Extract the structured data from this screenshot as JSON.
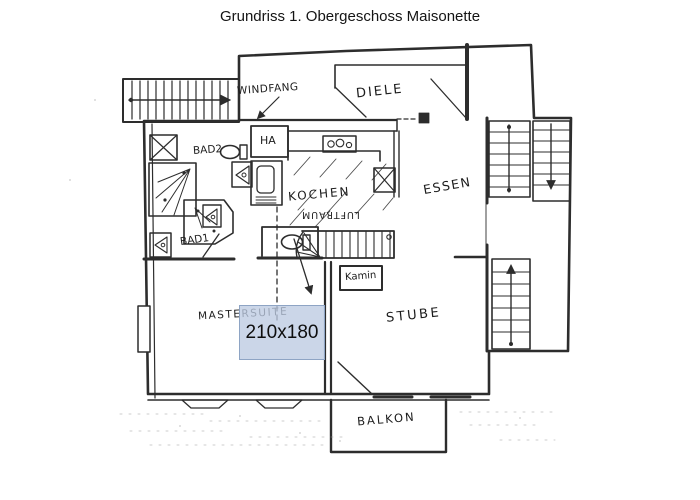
{
  "title": "Grundriss 1. Obergeschoss Maisonette",
  "colors": {
    "ink": "#2d2d2d",
    "paper": "#ffffff",
    "overlay_fill": "#bccbe2",
    "overlay_border": "#8ea4c4"
  },
  "rooms": {
    "windfang": "WINDFANG",
    "diele": "DIELE",
    "ha": "HA",
    "bad2": "BAD2",
    "kochen": "KOCHEN",
    "luftraum": "LUFTRAUM",
    "essen": "ESSEN",
    "bad1": "BAD1",
    "kamin": "Kamin",
    "mastersuite": "MASTERSUITE",
    "stube": "STUBE",
    "balkon": "BALKON"
  },
  "overlay": {
    "dimension": "210x180"
  },
  "icons": {
    "staircase": "stairs-with-direction-arrow",
    "toilet": "toilet-bowl",
    "stove": "stove-burners",
    "shower": "shower-spray",
    "sink": "sink-triangle",
    "shaft": "x-shaft"
  }
}
